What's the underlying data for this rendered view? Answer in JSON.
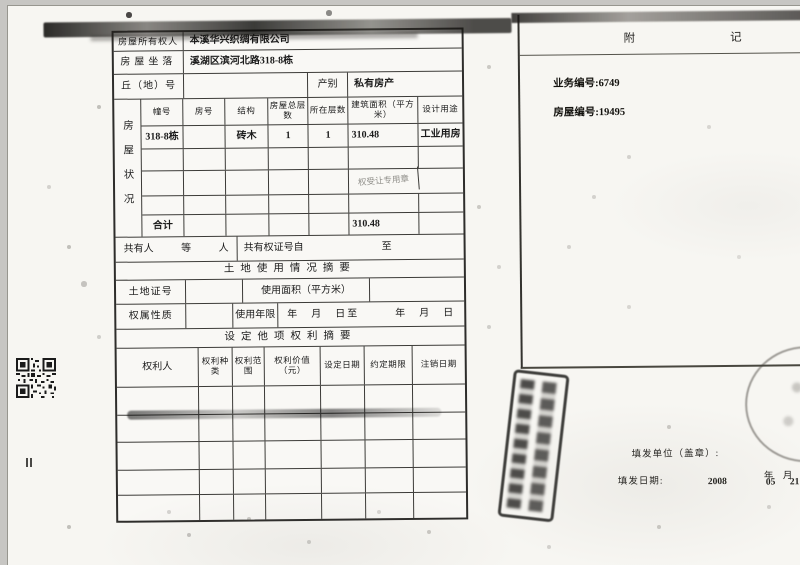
{
  "table": {
    "owner": {
      "label": "房屋所有权人",
      "value": "本溪华兴织绸有限公司"
    },
    "location": {
      "label": "房屋坐落",
      "value": "溪湖区滨河北路318-8栋"
    },
    "plot": {
      "label": "丘（地）号",
      "category_label": "产别",
      "category_value": "私有房产"
    },
    "housing": {
      "vertical_label": "房屋状况",
      "headers": [
        "幢号",
        "房号",
        "结构",
        "房屋总层数",
        "所在层数",
        "建筑面积（平方米）",
        "设计用途"
      ],
      "row1": [
        "318-8栋",
        "",
        "砖木",
        "1",
        "1",
        "310.48",
        "工业用房"
      ],
      "stamp_text": "权受让专用章",
      "total_label": "合计",
      "total_value": "310.48"
    },
    "co_owner": {
      "label": "共有人",
      "deng": "等",
      "ren": "人",
      "cert_label": "共有权证号自",
      "zhi": "至"
    },
    "land_title": "土地使用情况摘要",
    "land": {
      "cert_label": "土地证号",
      "area_label": "使用面积（平方米）"
    },
    "ownership": {
      "label": "权属性质",
      "term_label": "使用年限",
      "date_range": "年　月　日至　　　年　月　日"
    },
    "rights_title": "设定他项权利摘要",
    "rights": {
      "headers": [
        "权利人",
        "权利种类",
        "权利范围",
        "权利价值（元）",
        "设定日期",
        "约定期限",
        "注销日期"
      ]
    }
  },
  "panel": {
    "title": "附记",
    "notes": [
      "业务编号:6749",
      "房屋编号:19495"
    ]
  },
  "footer": {
    "issuer_label": "填发单位（盖章）:",
    "date_label": "填发日期:",
    "date_year": "2008",
    "date_month": "05",
    "date_day": "21",
    "year_label": "年",
    "month_label": "月",
    "day_label": "日"
  },
  "colors": {
    "paper": "#f7f6f2",
    "line": "#3c3b38",
    "ink": "#1b1b1b"
  }
}
